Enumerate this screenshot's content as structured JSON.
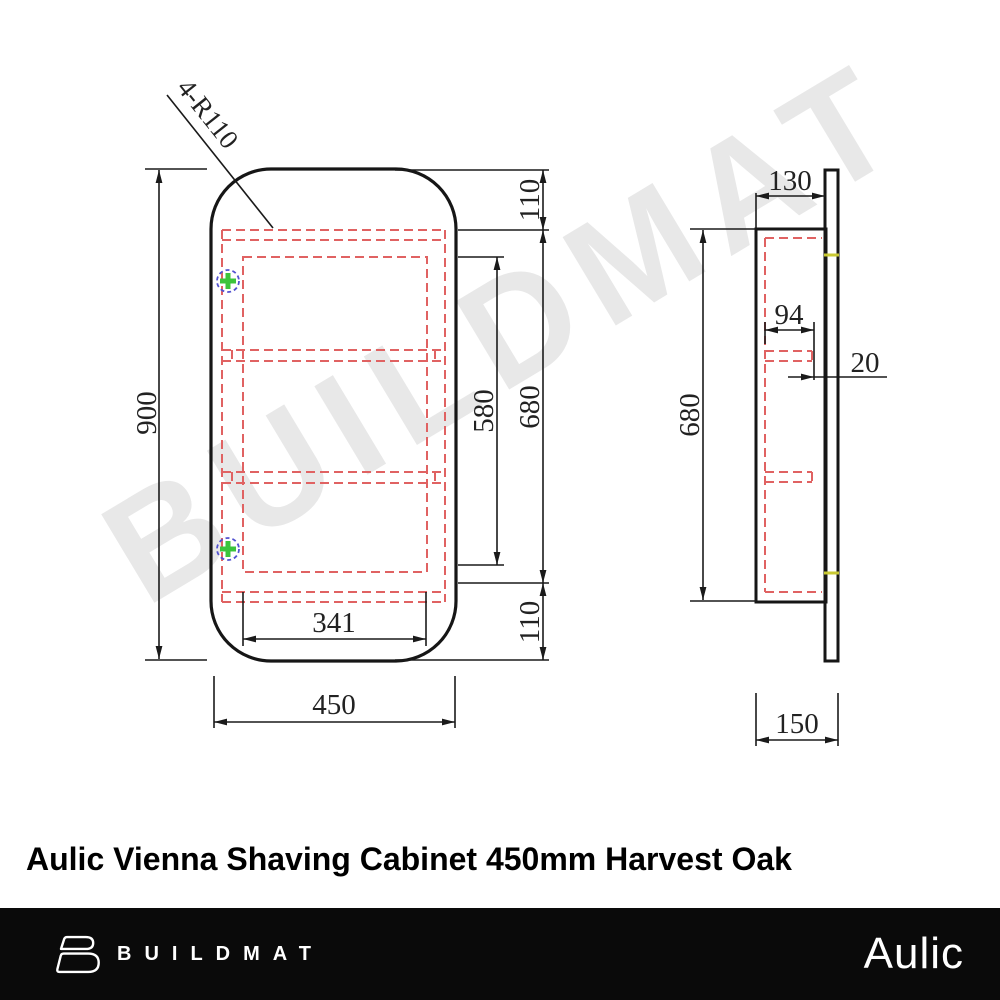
{
  "watermark": {
    "text": "BUILDMAT",
    "color": "#e8e8e8"
  },
  "title": "Aulic Vienna Shaving Cabinet 450mm Harvest Oak",
  "front_view": {
    "corner_radius_label": "4-R110",
    "overall_height": "900",
    "overall_width": "450",
    "inner_width": "341",
    "top_offset": "110",
    "opening_height": "680",
    "inner_height": "580",
    "bottom_offset": "110"
  },
  "side_view": {
    "body_depth": "130",
    "shelf_depth": "94",
    "door_offset": "20",
    "body_height": "680",
    "overall_depth": "150"
  },
  "footer": {
    "brand": "BUILDMAT",
    "logo_icon": "buildmat-b-icon",
    "sub_brand": "Aulic",
    "background": "#0a0a0a"
  },
  "colors": {
    "outline": "#161616",
    "hidden_line_red": "#e06262",
    "hinge_circle_blue": "#5252d0",
    "hinge_cross_green": "#3cc43c",
    "door_mark_yellow": "#c8c832",
    "dimension_text": "#222222"
  }
}
